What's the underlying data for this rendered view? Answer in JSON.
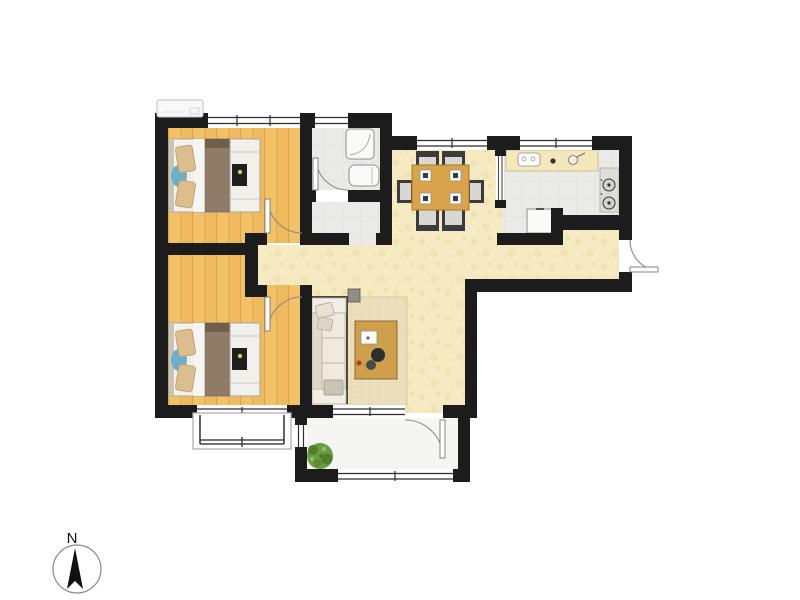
{
  "title": "apartment-floor-plan",
  "compass": {
    "label": "N"
  },
  "palette": {
    "wall": "#1c1c1c",
    "wood_floor": "#efba5f",
    "wood_floor_light": "#f3c168",
    "wood_line": "#d69e42",
    "hall_floor": "#f6eac2",
    "hall_speckle": "#eddfac",
    "tile_floor": "#eaeae6",
    "tile_line": "#dedfd8",
    "balcony_floor": "#f5f5f1",
    "counter": "#f3e7bb",
    "stove": "#deded9",
    "bed_frame": "#f2f1ec",
    "bed_blanket": "#8e7c69",
    "bed_blanket_fold": "#6f5e4a",
    "pillow": "#dcbe8e",
    "accent_blue": "#6faecb",
    "cabinet_white": "#f1f0eb",
    "tv_black": "#1f1f1f",
    "tv_dot": "#ccd14d",
    "sofa": "#ede8db",
    "sofa_trim": "#4a443c",
    "rug": "#ebdfbc",
    "rug_line": "#dfd2a8",
    "table_wood": "#d9a44c",
    "chair_dark": "#3b3b3b",
    "chair_seat": "#d8d7d2",
    "plant_green": "#6b9c40",
    "plant_dark": "#527e2c",
    "plant_light": "#8fbe63",
    "door_arc": "#8a8a8a",
    "fixture_white": "#fafaf8",
    "frame_gray": "#9a9a94",
    "glass_line": "#2c2c2c"
  },
  "rooms": [
    "bedroom-top",
    "bedroom-bottom",
    "bathroom",
    "dining-hall",
    "kitchen",
    "entry-foyer",
    "living-area",
    "balcony",
    "bay-window"
  ],
  "furniture": [
    "double-bed",
    "tv-cabinet",
    "sofa",
    "coffee-table",
    "rug",
    "side-table",
    "dining-table",
    "dining-chairs",
    "kitchen-counter",
    "sink",
    "cooktop",
    "fridge",
    "shower",
    "washbasin",
    "plant",
    "air-conditioner",
    "north-compass"
  ]
}
